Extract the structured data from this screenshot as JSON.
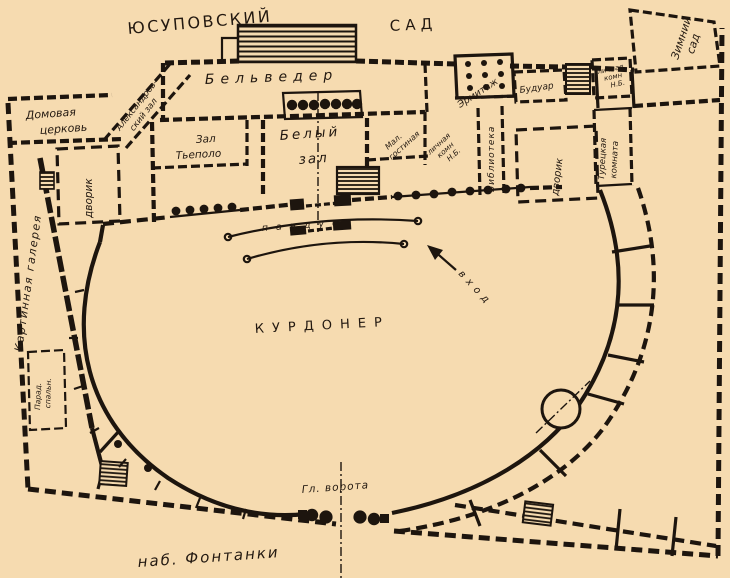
{
  "palette": {
    "paper": "#f6dbb0",
    "ink": "#1d150e"
  },
  "plan": {
    "title_garden_left": "ЮСУПОВСКИЙ",
    "title_garden_right": "САД",
    "winter_garden": [
      "Зимний",
      "сад"
    ],
    "belvedere": "Бельведер",
    "house_church": [
      "Домовая",
      "церковь"
    ],
    "alexander_hall": [
      "Александров-",
      "ский зал"
    ],
    "tiepolo_hall": [
      "Зал",
      "Тьеполо"
    ],
    "white_hall": [
      "Белый",
      "зал"
    ],
    "small_drawing_room": [
      "Мал.",
      "гостиная"
    ],
    "private_rooms_center": [
      "личная",
      "комн",
      "Н.Б."
    ],
    "hermitage": "Эрмитаж",
    "boudoir": "Будуар",
    "library": "Библиотека",
    "courtyard_left": "дворик",
    "courtyard_right": "дворик",
    "private_rooms_ne": [
      "личная",
      "комн",
      "Н.Б."
    ],
    "turkish_room": [
      "Турецкая",
      "комната"
    ],
    "picture_gallery": "Картинная галерея",
    "state_bedroom": [
      "Парад.",
      "спальн."
    ],
    "ramp": "пандус",
    "entrance": "вход",
    "cour_honneur": "КУРДОНЕР",
    "main_gate": "Гл. ворота",
    "embankment": "наб. Фонтанки"
  }
}
